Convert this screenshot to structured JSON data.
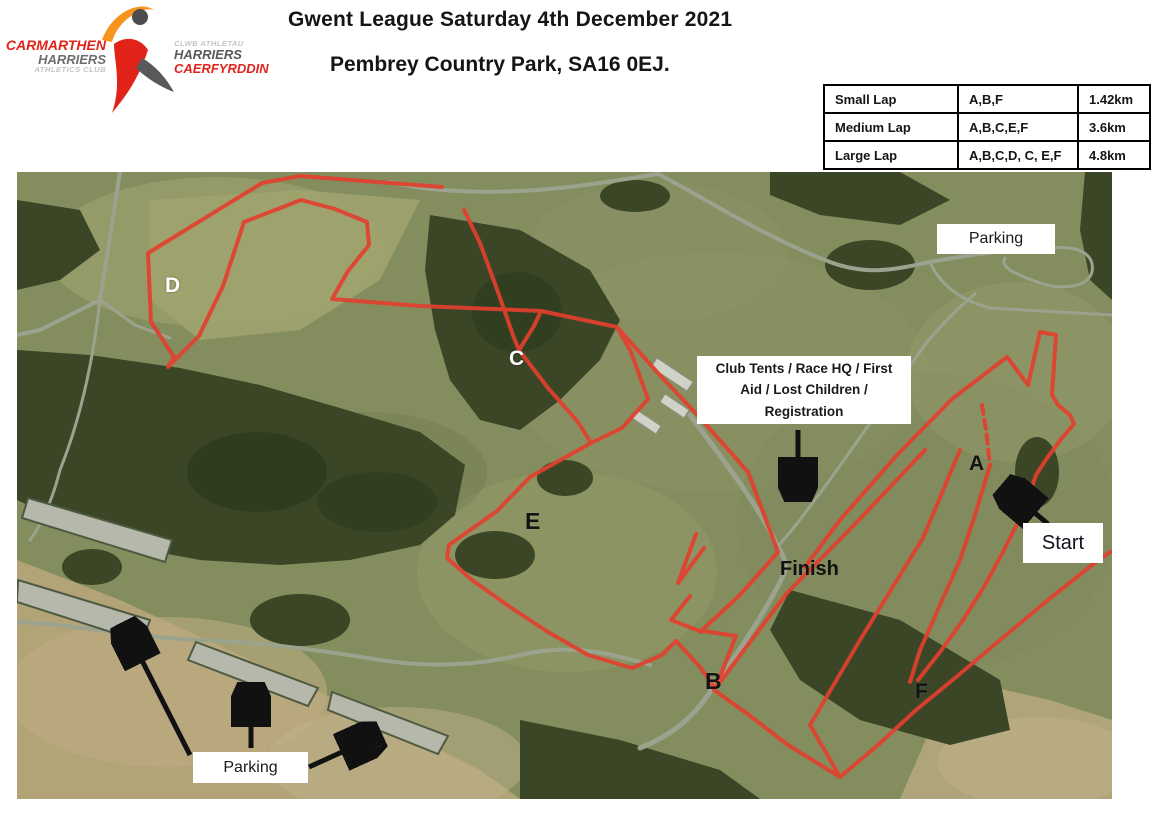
{
  "header": {
    "title": "Gwent League Saturday 4th December 2021",
    "subtitle": "Pembrey Country Park, SA16 0EJ."
  },
  "logo": {
    "club_line1": "CARMARTHEN",
    "club_line2": "HARRIERS",
    "club_line3": "ATHLETICS CLUB",
    "welsh_line1": "CLWB ATHLETAU",
    "welsh_line2": "HARRIERS",
    "welsh_line3": "CAERFYRDDIN"
  },
  "lap_table": {
    "rows": [
      {
        "lap": "Small Lap",
        "sections": "A,B,F",
        "distance": "1.42km"
      },
      {
        "lap": "Medium Lap",
        "sections": "A,B,C,E,F",
        "distance": "3.6km"
      },
      {
        "lap": "Large Lap",
        "sections": "A,B,C,D, C, E,F",
        "distance": "4.8km"
      }
    ]
  },
  "map_labels": {
    "parking_top": "Parking",
    "parking_bottom": "Parking",
    "club_tents_line1": "Club Tents / Race HQ / First",
    "club_tents_line2": "Aid / Lost Children /",
    "club_tents_line3": "Registration",
    "start": "Start",
    "finish": "Finish"
  },
  "checkpoints": [
    {
      "label": "A"
    },
    {
      "label": "B"
    },
    {
      "label": "C"
    },
    {
      "label": "D"
    },
    {
      "label": "E"
    },
    {
      "label": "F"
    }
  ],
  "colors": {
    "course_red": "#e2402e",
    "arrow_black": "#111111",
    "forest_green": "#3a4626",
    "grass_olive": "#848d5e",
    "dune_tan": "#b3a478",
    "road_grey": "#9ba38f",
    "logo_red": "#e2231a",
    "logo_orange": "#f7941d",
    "logo_grey": "#58595b"
  }
}
